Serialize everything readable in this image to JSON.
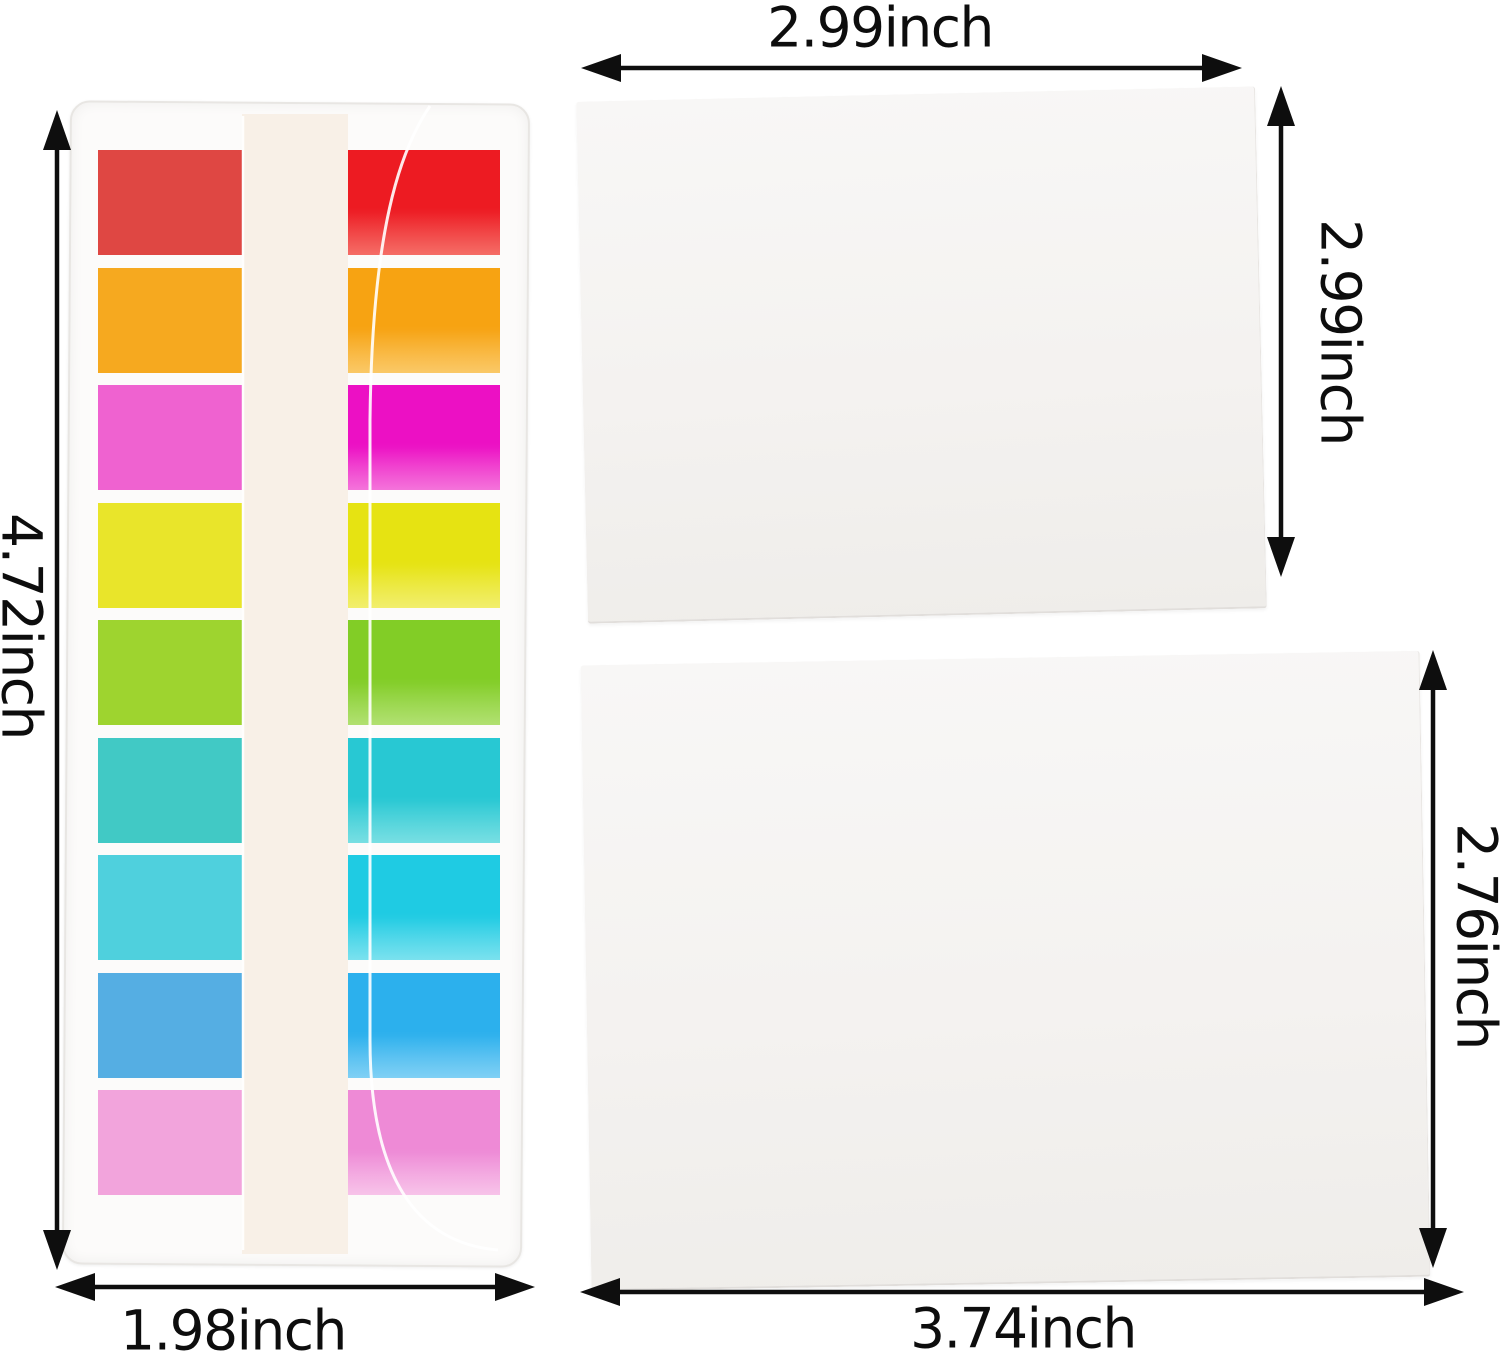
{
  "arrow_color": "#0e0e0e",
  "pad_fill": "#f4f2f0",
  "tab_case": {
    "height_label": "4.72inch",
    "width_label": "1.98inch",
    "case_fill": "#fcfbfa",
    "case_border": "#e8e6e3",
    "film_tint": "#f6eee2",
    "rows": [
      {
        "name": "red",
        "left": "#df4743",
        "right": "#ed1b22",
        "right_light": "#f2443c"
      },
      {
        "name": "orange",
        "left": "#f6a91f",
        "right": "#f7a312",
        "right_light": "#f9b93c"
      },
      {
        "name": "magenta",
        "left": "#ef62d0",
        "right": "#ec10c4",
        "right_light": "#f14cd0"
      },
      {
        "name": "yellow",
        "left": "#e9e52a",
        "right": "#e6e312",
        "right_light": "#eeea44"
      },
      {
        "name": "green",
        "left": "#9ed42f",
        "right": "#82cd26",
        "right_light": "#9bd84a"
      },
      {
        "name": "teal",
        "left": "#41c9c5",
        "right": "#28c8d3",
        "right_light": "#52d6db"
      },
      {
        "name": "cyan",
        "left": "#4fd0dd",
        "right": "#1fcbe3",
        "right_light": "#55d9ea"
      },
      {
        "name": "blue",
        "left": "#55aee3",
        "right": "#2cb0ed",
        "right_light": "#5cc3f2"
      },
      {
        "name": "light-pink",
        "left": "#f2a4dc",
        "right": "#ee8ad6",
        "right_light": "#f5b2e3"
      }
    ]
  },
  "square_pad": {
    "width_label": "2.99inch",
    "height_label": "2.99inch"
  },
  "large_pad": {
    "width_label": "3.74inch",
    "height_label": "2.76inch"
  }
}
